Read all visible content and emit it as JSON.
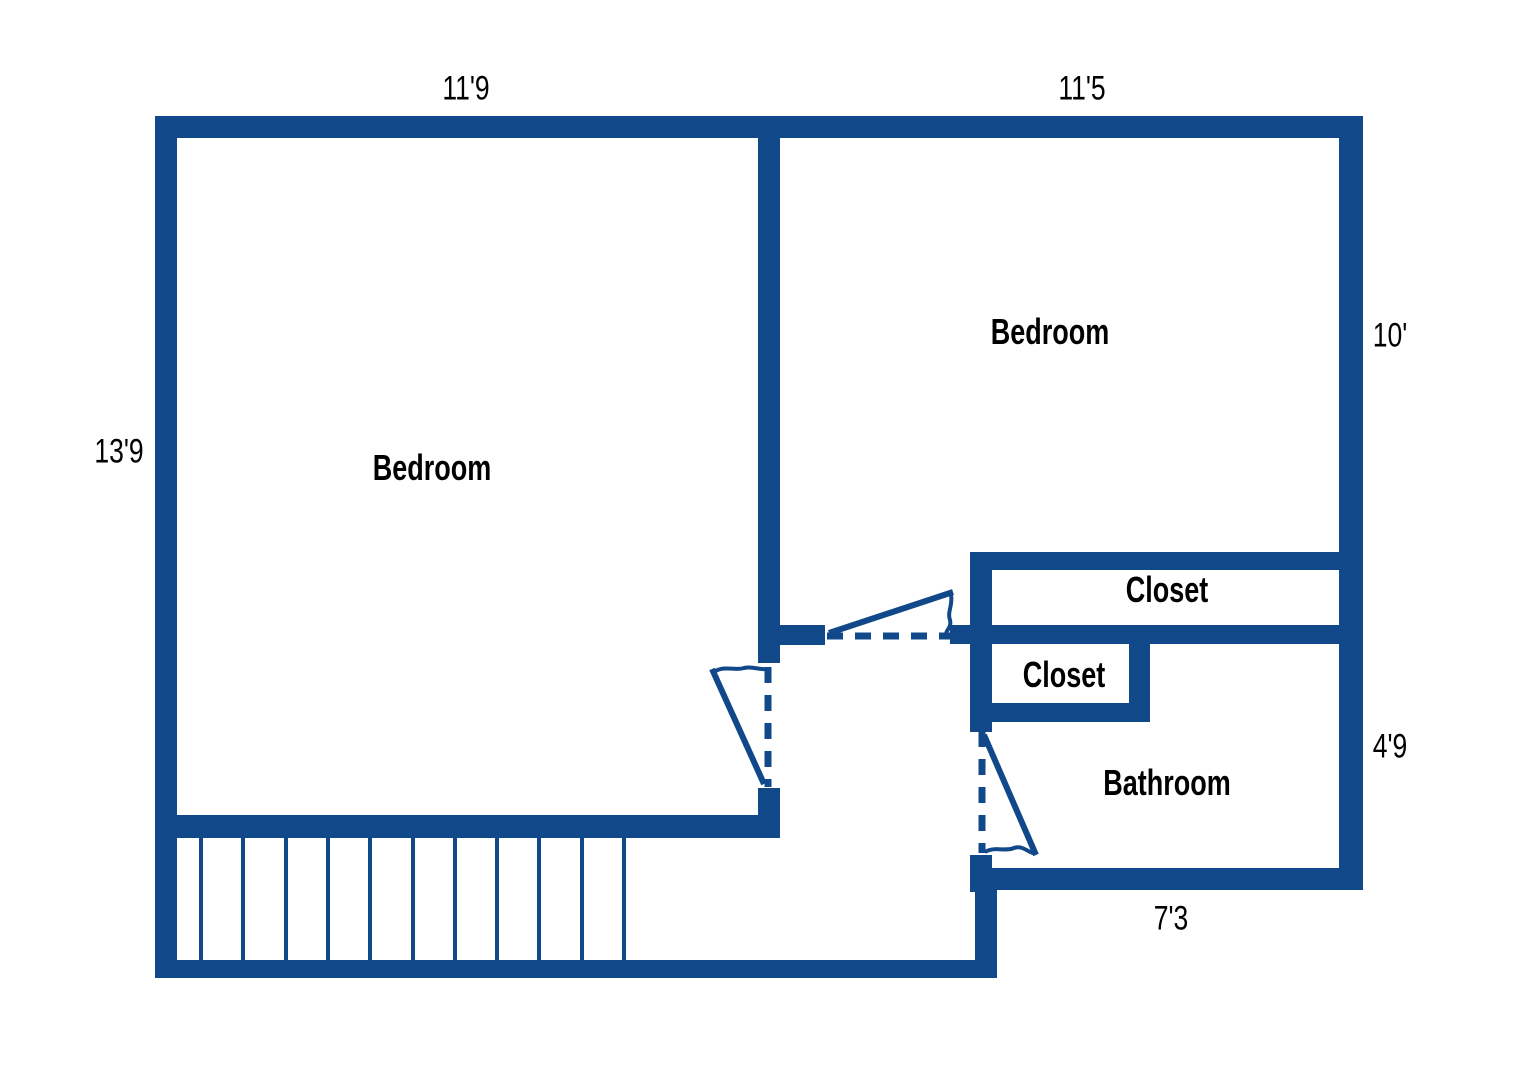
{
  "title": "Upper floor plan",
  "colors": {
    "wall": "#114889",
    "label": "#000000",
    "background": "#ffffff"
  },
  "rooms": {
    "bedroom_left": {
      "label": "Bedroom"
    },
    "bedroom_right": {
      "label": "Bedroom"
    },
    "closet_top": {
      "label": "Closet"
    },
    "closet_small": {
      "label": "Closet"
    },
    "bathroom": {
      "label": "Bathroom"
    }
  },
  "dimensions": {
    "bedroom_left_width": "11'9",
    "bedroom_right_width": "11'5",
    "bedroom_right_height": "10'",
    "bedroom_left_height": "13'9",
    "bathroom_height": "4'9",
    "bathroom_width": "7'3"
  },
  "features": {
    "stair_tread_count": 11,
    "door_count": 3
  }
}
